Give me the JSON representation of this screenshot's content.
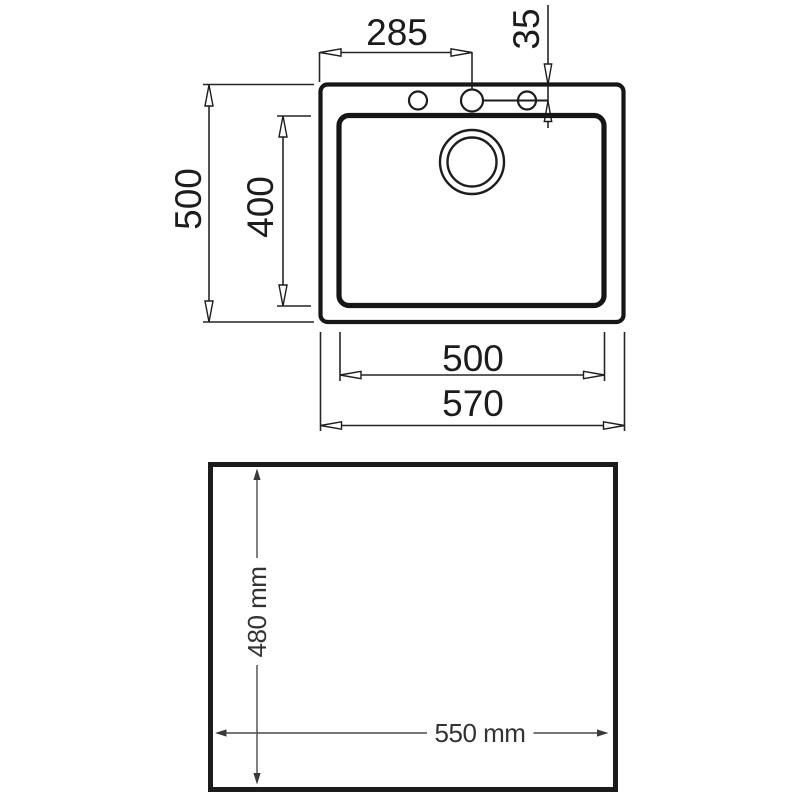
{
  "top_view": {
    "dim_faucet_center_from_left": "285",
    "dim_holes_from_top_edge": "35",
    "dim_overall_depth": "500",
    "dim_bowl_depth": "400",
    "dim_bowl_width": "500",
    "dim_overall_width": "570"
  },
  "cutout_view": {
    "dim_cutout_depth": "480 mm",
    "dim_cutout_width": "550 mm"
  },
  "colors": {
    "drawing_line": "#161616",
    "dimension_line": "#262626",
    "cutout_dimension_line": "#4a4a4a",
    "text": "#1c1c1c",
    "background": "#ffffff"
  }
}
